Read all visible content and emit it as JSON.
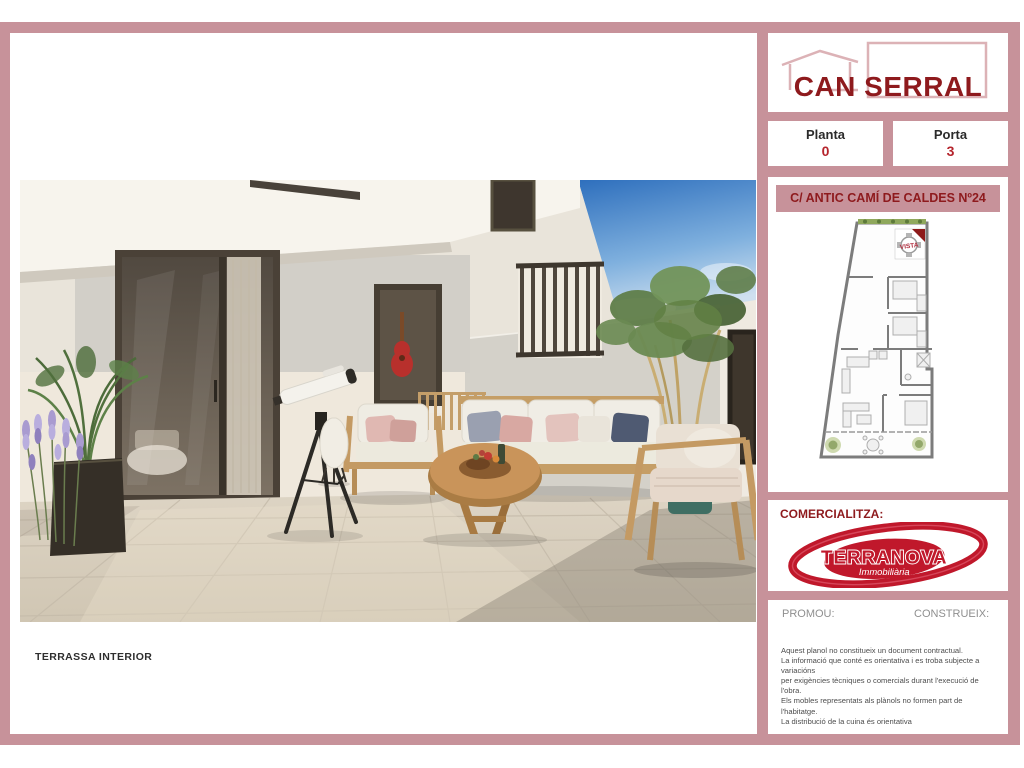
{
  "colors": {
    "frame_pink": "#c7929a",
    "dark_red": "#8e1a1d",
    "accent_red": "#b5242c",
    "label_gray": "#8f8f8f"
  },
  "photo": {
    "caption": "TERRASSA INTERIOR"
  },
  "sidebar": {
    "project": {
      "title": "CAN SERRAL"
    },
    "unit": {
      "planta_label": "Planta",
      "planta_value": "0",
      "porta_label": "Porta",
      "porta_value": "3"
    },
    "address": "C/ ANTIC CAMÍ DE CALDES Nº24",
    "floorplan": {
      "stamp": "VISTA"
    },
    "comercializa": {
      "label": "COMERCIALITZA:",
      "brand": "TERRANOVA",
      "brand_sub": "Immobiliària"
    },
    "promoters": {
      "promou_label": "PROMOU:",
      "construeix_label": "CONSTRUEIX:"
    },
    "disclaimer": {
      "lines": [
        "Aquest planol no constitueix un document contractual.",
        "La informació que conté es orientativa i es troba subjecte a variacións",
        "per exigències tècniques o comercials durant l'execució de l'obra.",
        "Els mobles representats als plànols no formen part de l'habitatge.",
        "La distribució de la cuina és orientativa"
      ]
    }
  }
}
